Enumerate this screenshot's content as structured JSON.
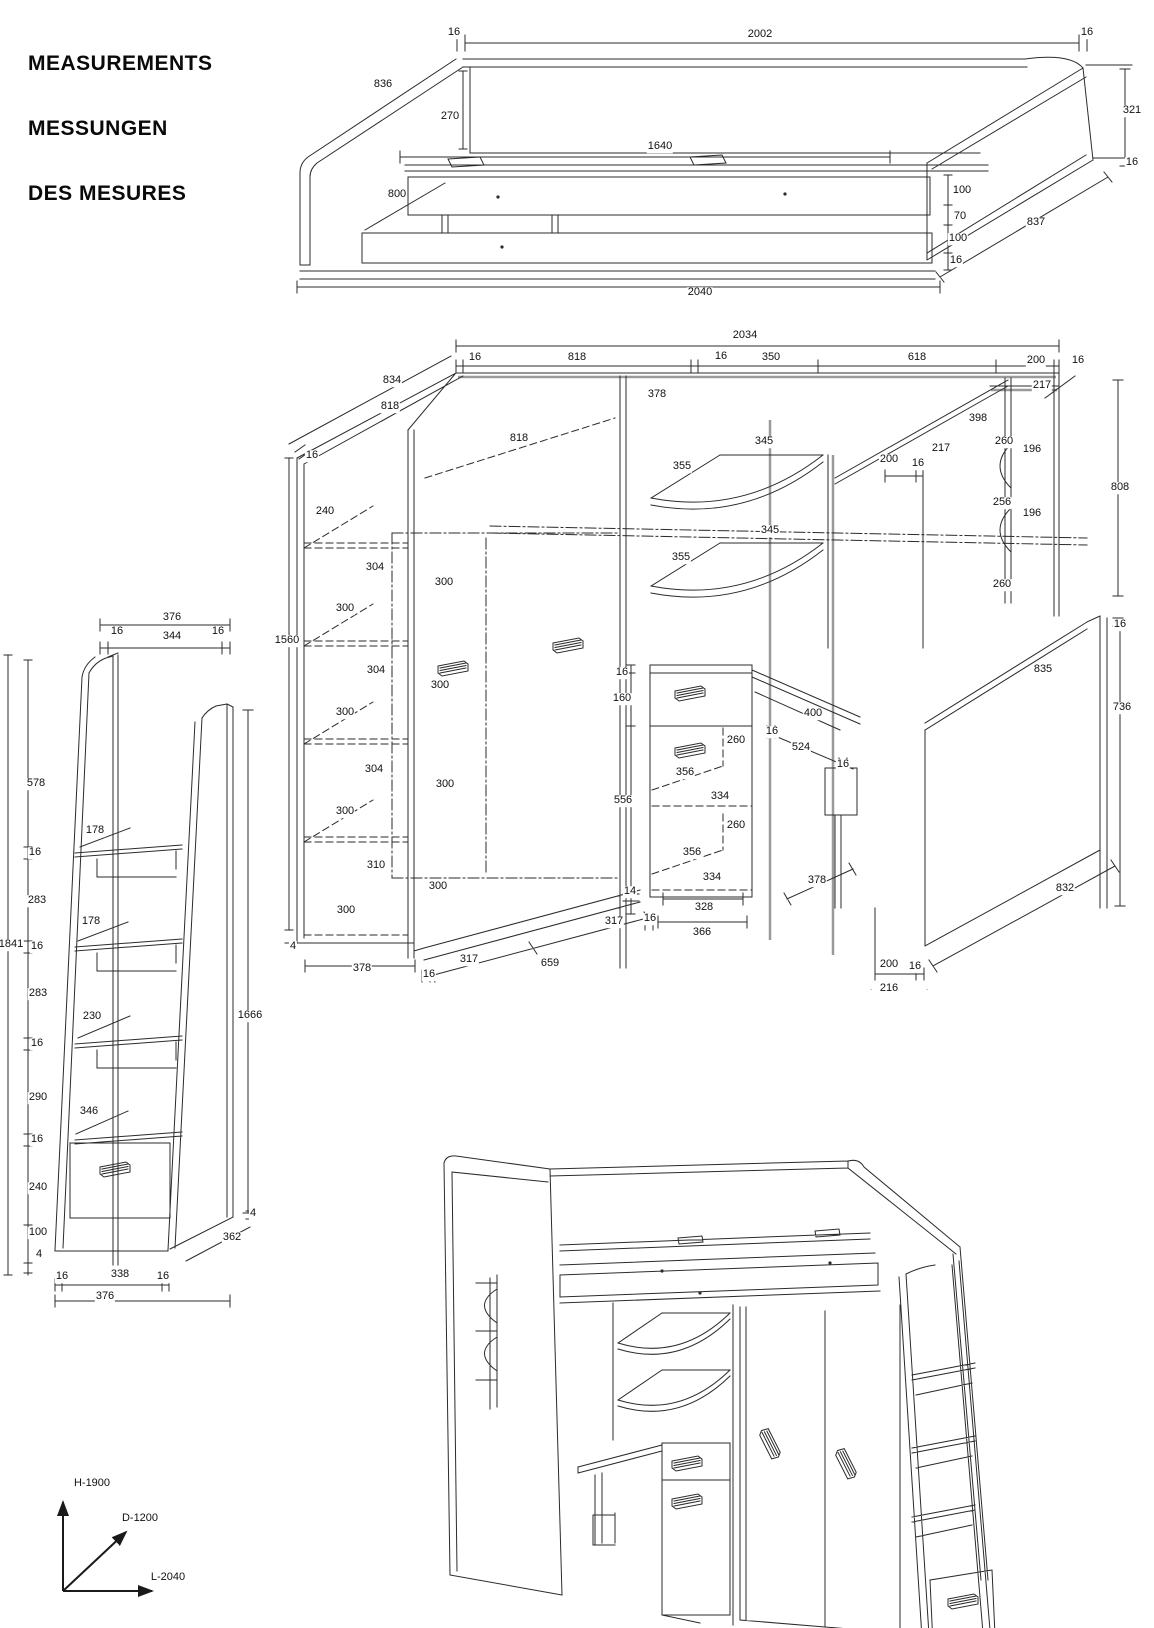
{
  "title": {
    "line1": "MEASUREMENTS",
    "line2": "MESSUNGEN",
    "line3": "DES MESURES"
  },
  "views": {
    "bed": {
      "labels": [
        {
          "t": "16",
          "x": 174,
          "y": 8
        },
        {
          "t": "2002",
          "x": 480,
          "y": 10
        },
        {
          "t": "16",
          "x": 807,
          "y": 8
        },
        {
          "t": "836",
          "x": 103,
          "y": 60
        },
        {
          "t": "270",
          "x": 170,
          "y": 92
        },
        {
          "t": "1640",
          "x": 380,
          "y": 122
        },
        {
          "t": "800",
          "x": 117,
          "y": 170
        },
        {
          "t": "100",
          "x": 682,
          "y": 166
        },
        {
          "t": "70",
          "x": 680,
          "y": 192
        },
        {
          "t": "100",
          "x": 678,
          "y": 214
        },
        {
          "t": "16",
          "x": 676,
          "y": 236
        },
        {
          "t": "837",
          "x": 756,
          "y": 198
        },
        {
          "t": "321",
          "x": 852,
          "y": 86
        },
        {
          "t": "16",
          "x": 852,
          "y": 138
        },
        {
          "t": "2040",
          "x": 420,
          "y": 268
        }
      ]
    },
    "wardrobe": {
      "labels": [
        {
          "t": "2034",
          "x": 470,
          "y": 18
        },
        {
          "t": "16",
          "x": 200,
          "y": 40
        },
        {
          "t": "818",
          "x": 302,
          "y": 40
        },
        {
          "t": "16",
          "x": 446,
          "y": 39
        },
        {
          "t": "350",
          "x": 496,
          "y": 40
        },
        {
          "t": "618",
          "x": 642,
          "y": 40
        },
        {
          "t": "200",
          "x": 761,
          "y": 43
        },
        {
          "t": "16",
          "x": 803,
          "y": 43
        },
        {
          "t": "834",
          "x": 117,
          "y": 63
        },
        {
          "t": "818",
          "x": 115,
          "y": 89
        },
        {
          "t": "378",
          "x": 382,
          "y": 77
        },
        {
          "t": "217",
          "x": 767,
          "y": 68
        },
        {
          "t": "398",
          "x": 703,
          "y": 101
        },
        {
          "t": "260",
          "x": 729,
          "y": 124
        },
        {
          "t": "196",
          "x": 757,
          "y": 132
        },
        {
          "t": "16",
          "x": 37,
          "y": 138
        },
        {
          "t": "818",
          "x": 244,
          "y": 121
        },
        {
          "t": "355",
          "x": 407,
          "y": 149
        },
        {
          "t": "345",
          "x": 489,
          "y": 124
        },
        {
          "t": "200",
          "x": 614,
          "y": 142
        },
        {
          "t": "16",
          "x": 643,
          "y": 146
        },
        {
          "t": "217",
          "x": 666,
          "y": 131
        },
        {
          "t": "256",
          "x": 727,
          "y": 185
        },
        {
          "t": "196",
          "x": 757,
          "y": 196
        },
        {
          "t": "808",
          "x": 845,
          "y": 170
        },
        {
          "t": "240",
          "x": 50,
          "y": 194
        },
        {
          "t": "355",
          "x": 406,
          "y": 240
        },
        {
          "t": "345",
          "x": 495,
          "y": 213
        },
        {
          "t": "260",
          "x": 727,
          "y": 267
        },
        {
          "t": "304",
          "x": 100,
          "y": 250
        },
        {
          "t": "300",
          "x": 169,
          "y": 265
        },
        {
          "t": "300",
          "x": 70,
          "y": 291
        },
        {
          "t": "1560",
          "x": 12,
          "y": 323
        },
        {
          "t": "16",
          "x": 845,
          "y": 307
        },
        {
          "t": "304",
          "x": 101,
          "y": 353
        },
        {
          "t": "300",
          "x": 165,
          "y": 368
        },
        {
          "t": "16",
          "x": 347,
          "y": 355
        },
        {
          "t": "160",
          "x": 347,
          "y": 381
        },
        {
          "t": "835",
          "x": 768,
          "y": 352
        },
        {
          "t": "736",
          "x": 847,
          "y": 390
        },
        {
          "t": "400",
          "x": 538,
          "y": 396
        },
        {
          "t": "16",
          "x": 497,
          "y": 414
        },
        {
          "t": "524",
          "x": 526,
          "y": 430
        },
        {
          "t": "16",
          "x": 568,
          "y": 447
        },
        {
          "t": "300",
          "x": 70,
          "y": 395
        },
        {
          "t": "304",
          "x": 99,
          "y": 452
        },
        {
          "t": "300",
          "x": 170,
          "y": 467
        },
        {
          "t": "300",
          "x": 70,
          "y": 494
        },
        {
          "t": "310",
          "x": 101,
          "y": 548
        },
        {
          "t": "300",
          "x": 163,
          "y": 569
        },
        {
          "t": "300",
          "x": 71,
          "y": 593
        },
        {
          "t": "4",
          "x": 18,
          "y": 629
        },
        {
          "t": "378",
          "x": 87,
          "y": 651
        },
        {
          "t": "16",
          "x": 154,
          "y": 657
        },
        {
          "t": "317",
          "x": 194,
          "y": 642
        },
        {
          "t": "659",
          "x": 275,
          "y": 646
        },
        {
          "t": "317",
          "x": 339,
          "y": 604
        },
        {
          "t": "14",
          "x": 355,
          "y": 574
        },
        {
          "t": "16",
          "x": 375,
          "y": 601
        },
        {
          "t": "328",
          "x": 429,
          "y": 590
        },
        {
          "t": "366",
          "x": 427,
          "y": 615
        },
        {
          "t": "334",
          "x": 437,
          "y": 560
        },
        {
          "t": "356",
          "x": 417,
          "y": 535
        },
        {
          "t": "260",
          "x": 461,
          "y": 508
        },
        {
          "t": "334",
          "x": 445,
          "y": 479
        },
        {
          "t": "356",
          "x": 410,
          "y": 455
        },
        {
          "t": "260",
          "x": 461,
          "y": 423
        },
        {
          "t": "556",
          "x": 348,
          "y": 483
        },
        {
          "t": "378",
          "x": 542,
          "y": 563
        },
        {
          "t": "832",
          "x": 790,
          "y": 571
        },
        {
          "t": "200",
          "x": 614,
          "y": 647
        },
        {
          "t": "16",
          "x": 640,
          "y": 649
        },
        {
          "t": "216",
          "x": 614,
          "y": 671
        }
      ]
    },
    "ladder": {
      "labels": [
        {
          "t": "376",
          "x": 172,
          "y": 33
        },
        {
          "t": "16",
          "x": 117,
          "y": 47
        },
        {
          "t": "344",
          "x": 172,
          "y": 52
        },
        {
          "t": "16",
          "x": 218,
          "y": 47
        },
        {
          "t": "578",
          "x": 36,
          "y": 199
        },
        {
          "t": "178",
          "x": 95,
          "y": 246
        },
        {
          "t": "16",
          "x": 35,
          "y": 268
        },
        {
          "t": "283",
          "x": 37,
          "y": 316
        },
        {
          "t": "178",
          "x": 91,
          "y": 337
        },
        {
          "t": "1841",
          "x": 11,
          "y": 360
        },
        {
          "t": "16",
          "x": 37,
          "y": 362
        },
        {
          "t": "283",
          "x": 38,
          "y": 409
        },
        {
          "t": "230",
          "x": 92,
          "y": 432
        },
        {
          "t": "16",
          "x": 37,
          "y": 459
        },
        {
          "t": "290",
          "x": 38,
          "y": 513
        },
        {
          "t": "346",
          "x": 89,
          "y": 527
        },
        {
          "t": "16",
          "x": 37,
          "y": 555
        },
        {
          "t": "240",
          "x": 38,
          "y": 603
        },
        {
          "t": "100",
          "x": 38,
          "y": 648
        },
        {
          "t": "4",
          "x": 39,
          "y": 670
        },
        {
          "t": "1666",
          "x": 250,
          "y": 431
        },
        {
          "t": "4",
          "x": 253,
          "y": 629
        },
        {
          "t": "362",
          "x": 232,
          "y": 653
        },
        {
          "t": "16",
          "x": 62,
          "y": 692
        },
        {
          "t": "338",
          "x": 120,
          "y": 690
        },
        {
          "t": "16",
          "x": 163,
          "y": 692
        },
        {
          "t": "376",
          "x": 105,
          "y": 712
        }
      ]
    },
    "perspective": {
      "labels": []
    },
    "axes": {
      "labels": [
        {
          "t": "H-1900",
          "x": 52,
          "y": 16
        },
        {
          "t": "D-1200",
          "x": 100,
          "y": 51
        },
        {
          "t": "L-2040",
          "x": 128,
          "y": 110
        }
      ]
    }
  }
}
